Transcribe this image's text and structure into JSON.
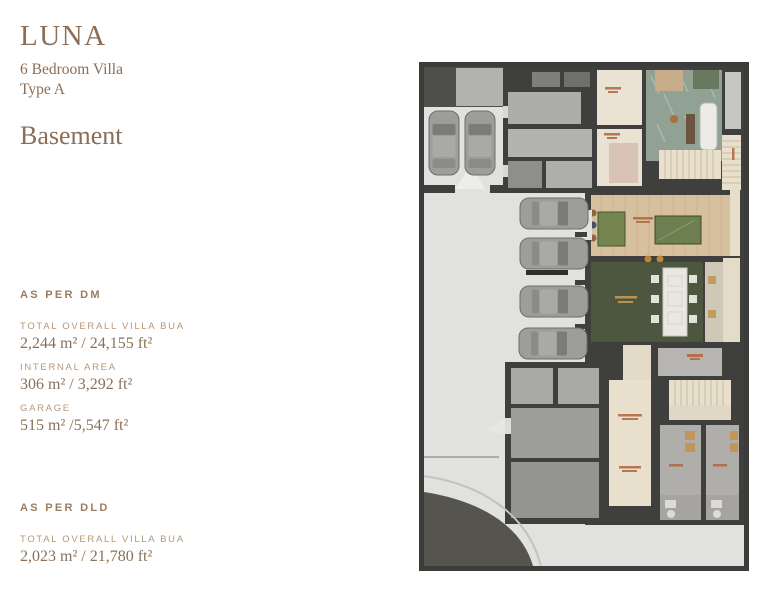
{
  "theme": {
    "page_bg": "#ffffff",
    "heading_color": "#8a6e57",
    "section_heading_color": "#9c7c5f",
    "label_color": "#b49878",
    "value_color": "#8a7057"
  },
  "header": {
    "project": "LUNA",
    "subtitle_line1": "6 Bedroom Villa",
    "subtitle_line2": "Type A",
    "floor": "Basement"
  },
  "as_per_dm": {
    "heading": "AS PER DM",
    "items": [
      {
        "label": "TOTAL OVERALL VILLA BUA",
        "value": "2,244 m² / 24,155 ft²"
      },
      {
        "label": "INTERNAL AREA",
        "value": "306 m² / 3,292 ft²"
      },
      {
        "label": "GARAGE",
        "value": "515 m² /5,547 ft²"
      }
    ]
  },
  "as_per_dld": {
    "heading": "AS PER DLD",
    "items": [
      {
        "label": "TOTAL OVERALL VILLA BUA",
        "value": "2,023 m² / 21,780 ft²"
      }
    ]
  },
  "floor_plan": {
    "type": "basement-floor-plan",
    "parked_cars": 6,
    "colors": {
      "wall": "#3c3c3a",
      "garage_floor": "#e1e1df",
      "wood_floor": "#d7c09e",
      "majlis_green": "#4d573f",
      "spa_marble": "#91a294",
      "corridor_beige": "#e8dfcc",
      "room_label": "#b0653f"
    }
  }
}
